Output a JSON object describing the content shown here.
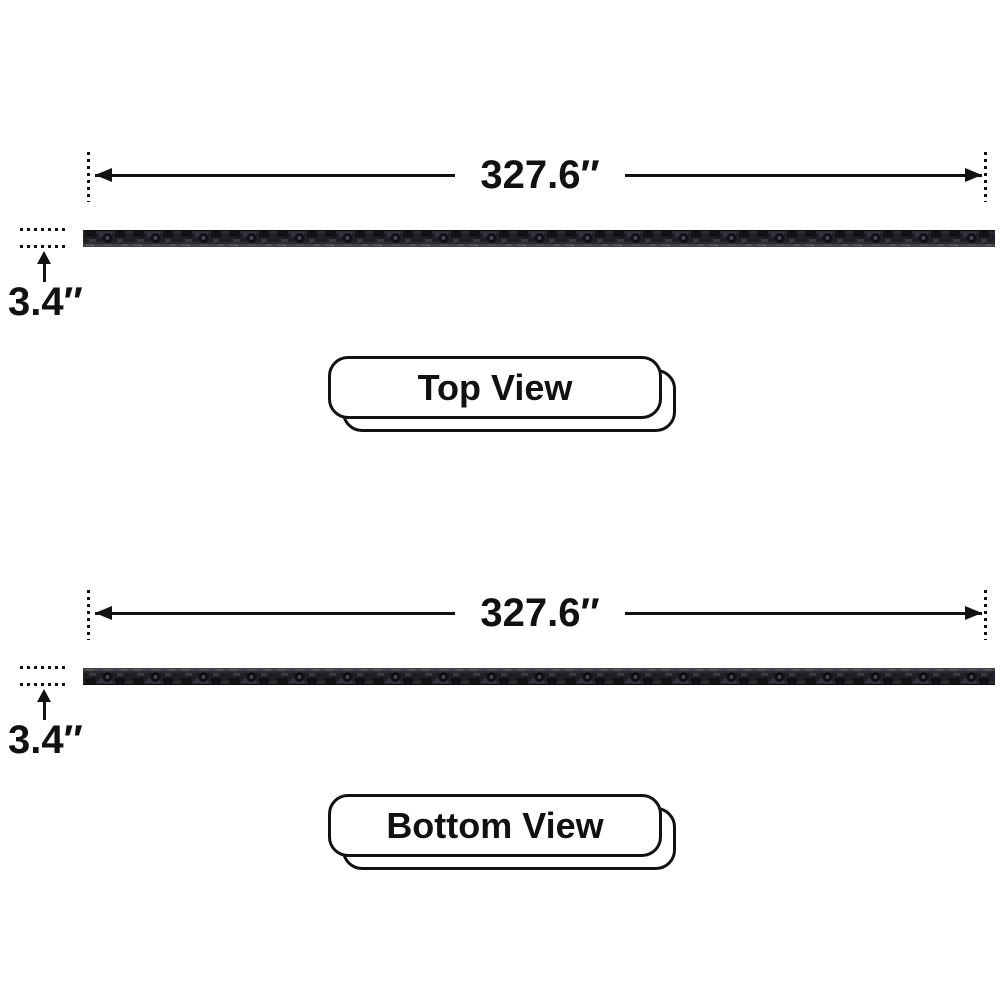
{
  "diagram": {
    "description_labels": {
      "length": "327.6″",
      "height": "3.4″"
    },
    "views": [
      {
        "id": "top",
        "length_label": "327.6″",
        "height_label": "3.4″",
        "view_label": "Top View"
      },
      {
        "id": "bottom",
        "length_label": "327.6″",
        "height_label": "3.4″",
        "view_label": "Bottom View"
      }
    ],
    "colors": {
      "ink": "#111111",
      "background": "#ffffff",
      "bar_base": "#2a2a31",
      "bar_dark": "#121216",
      "bar_mid": "#1e1e24",
      "bar_light": "#41414a"
    }
  }
}
